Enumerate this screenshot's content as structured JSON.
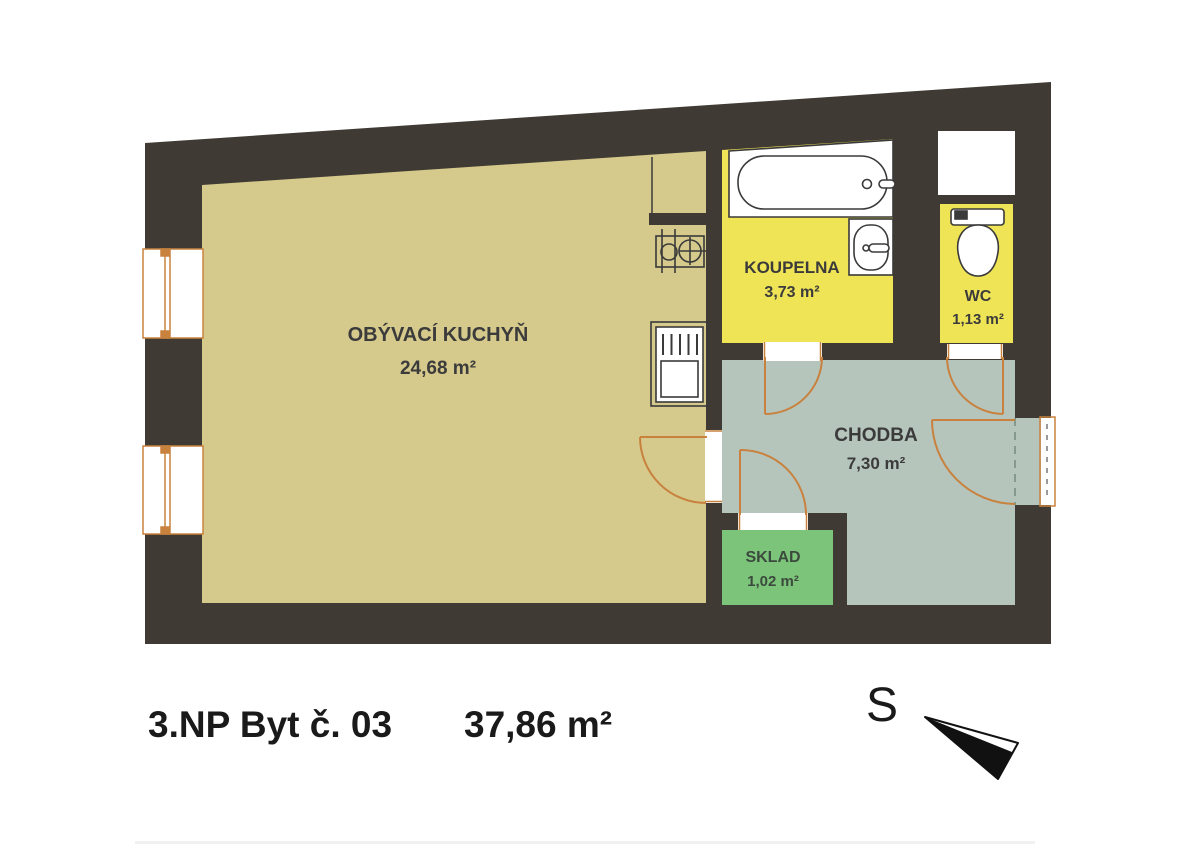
{
  "title": {
    "floor_and_unit": "3.NP Byt č. 03",
    "total_area": "37,86 m²"
  },
  "compass": {
    "north_label": "S"
  },
  "rooms": [
    {
      "name": "OBÝVACÍ KUCHYŇ",
      "area": "24,68 m²",
      "color": "#d5c98c"
    },
    {
      "name": "KOUPELNA",
      "area": "3,73 m²",
      "color": "#efe356"
    },
    {
      "name": "WC",
      "area": "1,13 m²",
      "color": "#efe356"
    },
    {
      "name": "CHODBA",
      "area": "7,30 m²",
      "color": "#b6c5bc"
    },
    {
      "name": "SKLAD",
      "area": "1,02 m²",
      "color": "#7cc47a"
    }
  ],
  "colors": {
    "wall": "#3f3a33",
    "door_window": "#c8823e",
    "fixture_outline": "#3a3a3a",
    "label_text": "#3b3b3b",
    "sklad_label_text": "#3c4a3e",
    "title_text": "#1a1a1a",
    "white": "#ffffff"
  },
  "icons": [
    "bathtub-icon",
    "washbasin-icon",
    "toilet-icon",
    "kitchen-sink-icon",
    "stove-icon",
    "window-icon",
    "door-swing-icon",
    "north-arrow-icon"
  ]
}
